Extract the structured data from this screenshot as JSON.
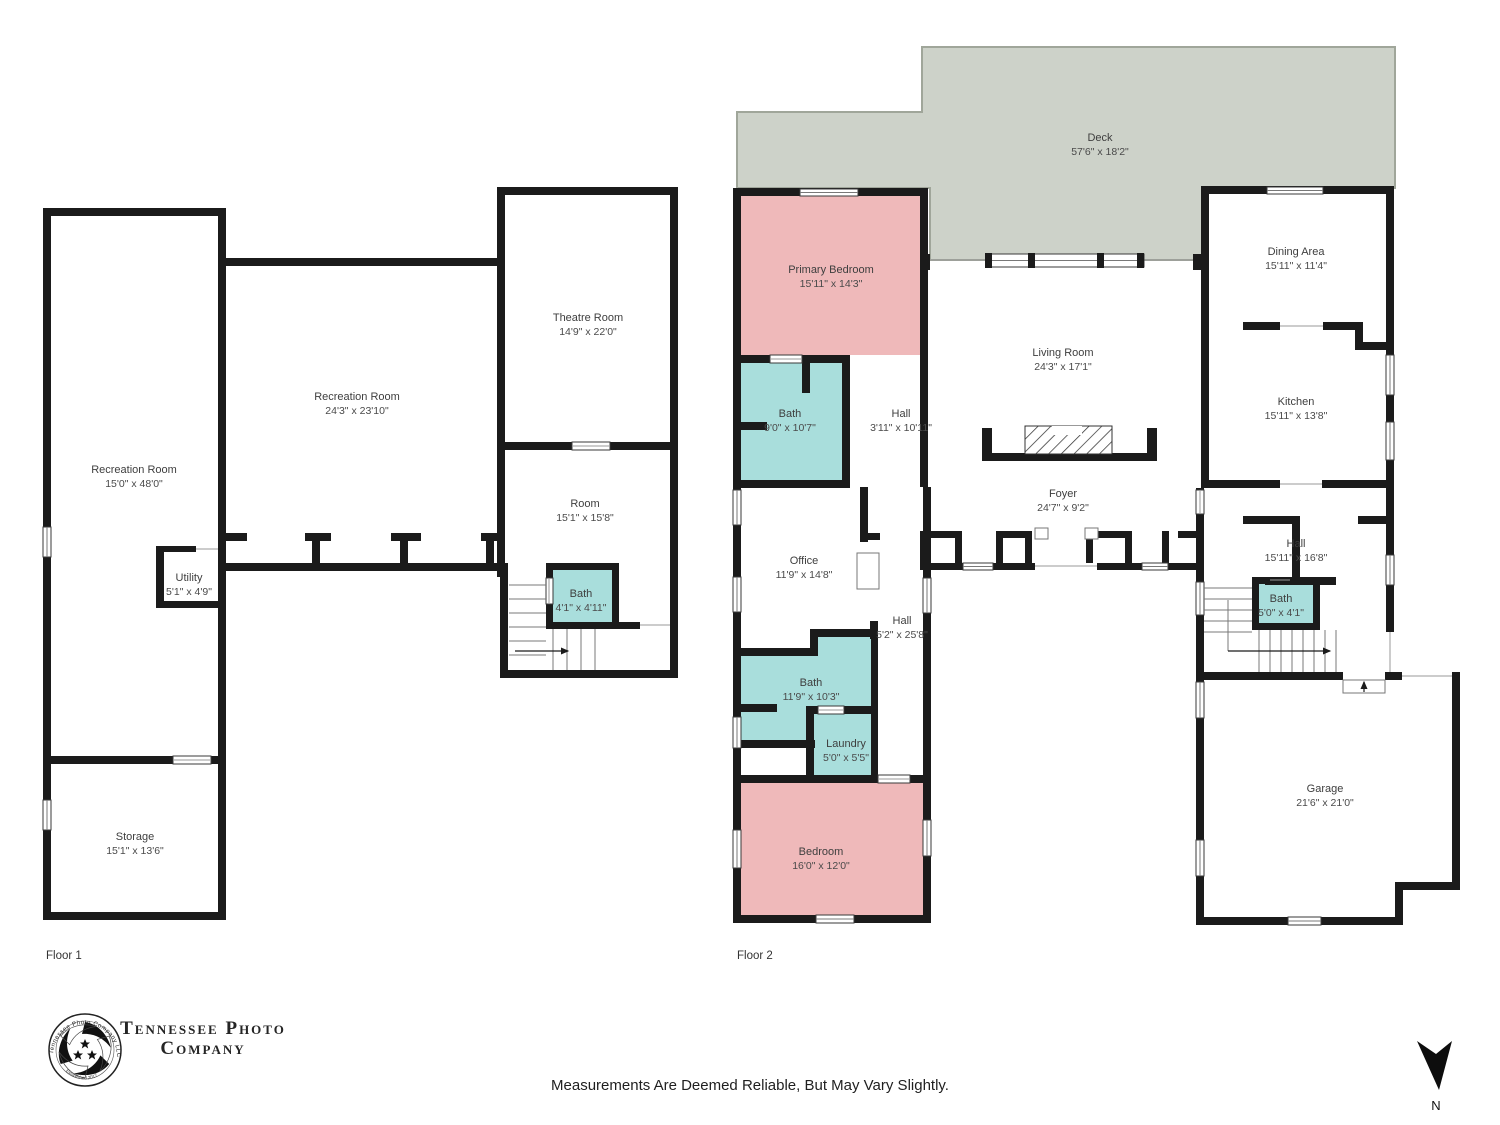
{
  "floors": [
    {
      "label": "Floor 1",
      "rooms": [
        {
          "name": "Recreation Room",
          "dims": "15'0\" x 48'0\""
        },
        {
          "name": "Recreation Room",
          "dims": "24'3\" x 23'10\""
        },
        {
          "name": "Theatre Room",
          "dims": "14'9\" x 22'0\""
        },
        {
          "name": "Room",
          "dims": "15'1\" x 15'8\""
        },
        {
          "name": "Utility",
          "dims": "5'1\" x 4'9\""
        },
        {
          "name": "Bath",
          "dims": "4'1\" x 4'11\""
        },
        {
          "name": "Storage",
          "dims": "15'1\" x 13'6\""
        }
      ]
    },
    {
      "label": "Floor 2",
      "rooms": [
        {
          "name": "Deck",
          "dims": "57'6\" x 18'2\""
        },
        {
          "name": "Primary Bedroom",
          "dims": "15'11\" x 14'3\""
        },
        {
          "name": "Bath",
          "dims": "9'0\" x 10'7\""
        },
        {
          "name": "Hall",
          "dims": "3'11\" x 10'11\""
        },
        {
          "name": "Living Room",
          "dims": "24'3\" x 17'1\""
        },
        {
          "name": "Dining Area",
          "dims": "15'11\" x 11'4\""
        },
        {
          "name": "Kitchen",
          "dims": "15'11\" x 13'8\""
        },
        {
          "name": "Foyer",
          "dims": "24'7\" x 9'2\""
        },
        {
          "name": "Office",
          "dims": "11'9\" x 14'8\""
        },
        {
          "name": "Hall",
          "dims": "15'11\" x 16'8\""
        },
        {
          "name": "Hall",
          "dims": "5'2\" x 25'8\""
        },
        {
          "name": "Bath",
          "dims": "5'0\" x 4'1\""
        },
        {
          "name": "Bath",
          "dims": "11'9\" x 10'3\""
        },
        {
          "name": "Laundry",
          "dims": "5'0\" x 5'5\""
        },
        {
          "name": "Bedroom",
          "dims": "16'0\" x 12'0\""
        },
        {
          "name": "Garage",
          "dims": "21'6\" x 21'0\""
        }
      ]
    }
  ],
  "branding": {
    "name_line1": "Tennessee Photo",
    "name_line2": "Company",
    "badge_top": "Tennessee Photo Company LLC",
    "badge_bottom": "Established 2017"
  },
  "disclaimer": "Measurements Are Deemed Reliable, But May Vary Slightly.",
  "compass": {
    "label": "N"
  },
  "colors": {
    "wall": "#1b1b1b",
    "bedroom_fill": "#efb9ba",
    "bath_fill": "#a9dedc",
    "deck_fill": "#cdd2c9"
  }
}
